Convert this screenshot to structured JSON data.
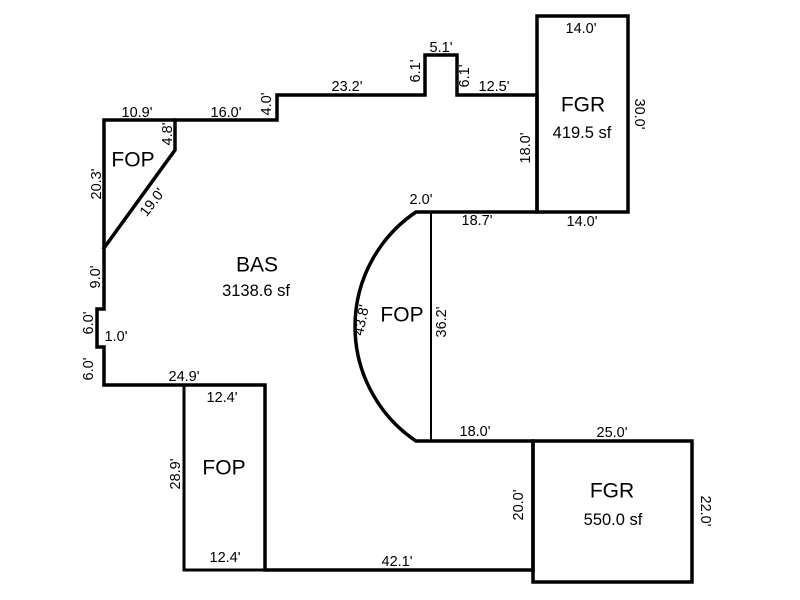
{
  "sketch": {
    "type": "floorplan-sketch",
    "background_color": "#ffffff",
    "line_color": "#000000",
    "rooms": [
      {
        "code": "FOP",
        "area": null,
        "x": 133,
        "y": 159,
        "area_x": null,
        "area_y": null
      },
      {
        "code": "BAS",
        "area": "3138.6 sf",
        "x": 257,
        "y": 264,
        "area_x": 256,
        "area_y": 290
      },
      {
        "code": "FGR",
        "area": "419.5 sf",
        "x": 583,
        "y": 104,
        "area_x": 582,
        "area_y": 132
      },
      {
        "code": "FOP",
        "area": null,
        "x": 402,
        "y": 314,
        "area_x": null,
        "area_y": null
      },
      {
        "code": "FOP",
        "area": null,
        "x": 224,
        "y": 467,
        "area_x": null,
        "area_y": null
      },
      {
        "code": "FGR",
        "area": "550.0 sf",
        "x": 612,
        "y": 490,
        "area_x": 613,
        "area_y": 519
      }
    ],
    "dimensions": [
      {
        "text": "10.9'",
        "x": 137,
        "y": 112,
        "rot": 0
      },
      {
        "text": "16.0'",
        "x": 226,
        "y": 112,
        "rot": 0
      },
      {
        "text": "4.0'",
        "x": 266,
        "y": 104,
        "rot": -90
      },
      {
        "text": "23.2'",
        "x": 347,
        "y": 86,
        "rot": 0
      },
      {
        "text": "6.1'",
        "x": 415,
        "y": 71,
        "rot": -90
      },
      {
        "text": "5.1'",
        "x": 441,
        "y": 47,
        "rot": 0
      },
      {
        "text": "6.1'",
        "x": 464,
        "y": 76,
        "rot": -90
      },
      {
        "text": "12.5'",
        "x": 494,
        "y": 86,
        "rot": 0
      },
      {
        "text": "14.0'",
        "x": 581,
        "y": 28,
        "rot": 0
      },
      {
        "text": "30.0'",
        "x": 640,
        "y": 114,
        "rot": 90
      },
      {
        "text": "18.0'",
        "x": 525,
        "y": 148,
        "rot": -90
      },
      {
        "text": "14.0'",
        "x": 582,
        "y": 221,
        "rot": 0
      },
      {
        "text": "2.0'",
        "x": 421,
        "y": 199,
        "rot": 0
      },
      {
        "text": "18.7'",
        "x": 477,
        "y": 220,
        "rot": 0
      },
      {
        "text": "20.3'",
        "x": 96,
        "y": 184,
        "rot": -90
      },
      {
        "text": "4.8'",
        "x": 167,
        "y": 134,
        "rot": -90
      },
      {
        "text": "19.0'",
        "x": 152,
        "y": 202,
        "rot": -52
      },
      {
        "text": "9.0'",
        "x": 95,
        "y": 277,
        "rot": -90
      },
      {
        "text": "6.0'",
        "x": 88,
        "y": 323,
        "rot": -90
      },
      {
        "text": "1.0'",
        "x": 116,
        "y": 336,
        "rot": 0
      },
      {
        "text": "6.0'",
        "x": 88,
        "y": 369,
        "rot": -90
      },
      {
        "text": "24.9'",
        "x": 184,
        "y": 376,
        "rot": 0
      },
      {
        "text": "12.4'",
        "x": 222,
        "y": 397,
        "rot": 0
      },
      {
        "text": "28.9'",
        "x": 175,
        "y": 474,
        "rot": -90
      },
      {
        "text": "12.4'",
        "x": 225,
        "y": 557,
        "rot": 0
      },
      {
        "text": "43.8'",
        "x": 361,
        "y": 320,
        "rot": -78
      },
      {
        "text": "36.2'",
        "x": 441,
        "y": 322,
        "rot": -90
      },
      {
        "text": "18.0'",
        "x": 475,
        "y": 431,
        "rot": 0
      },
      {
        "text": "25.0'",
        "x": 612,
        "y": 432,
        "rot": 0
      },
      {
        "text": "20.0'",
        "x": 518,
        "y": 505,
        "rot": -90
      },
      {
        "text": "22.0'",
        "x": 706,
        "y": 511,
        "rot": 90
      },
      {
        "text": "42.1'",
        "x": 397,
        "y": 561,
        "rot": 0
      }
    ]
  }
}
